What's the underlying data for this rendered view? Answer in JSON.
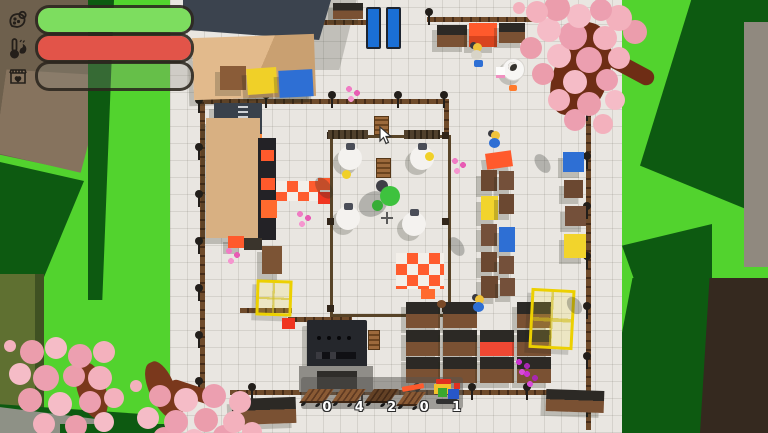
{
  "hud": {
    "bars": [
      {
        "id": "resources",
        "icon": "seed-sack-icon",
        "fill_pct": 100,
        "fill_color": "#7ddd5f"
      },
      {
        "id": "temperature",
        "icon": "thermometer-fire-icon",
        "fill_pct": 100,
        "fill_color": "#e25449"
      },
      {
        "id": "shop-appeal",
        "icon": "shop-heart-icon",
        "fill_pct": 0,
        "fill_color": "transparent"
      }
    ]
  },
  "pause": {
    "icon": "pause-icon",
    "color": "#1a6fd6"
  },
  "hotbar": {
    "slots": [
      {
        "item": "wooden-pallet",
        "count": "0"
      },
      {
        "item": "wooden-pallet",
        "count": "4"
      },
      {
        "item": "dark-wooden-pallet",
        "count": "2"
      },
      {
        "item": "pallet-with-orange-plank",
        "count": "0"
      },
      {
        "item": "toy-train",
        "count": "1"
      }
    ]
  },
  "colors": {
    "grass": "#52d32e",
    "grass_shadow": "#0d5a11",
    "tile": "#e9e6e1",
    "fence": "#6f4b2b",
    "pause_blue": "#1a6fd6",
    "orange": "#ff5a2c",
    "yellow": "#f0d028",
    "blue": "#2e6fd4",
    "crate_brown": "#6b4831",
    "player_green": "#3ec23e",
    "blossom_pink": "#f3b1bd"
  }
}
